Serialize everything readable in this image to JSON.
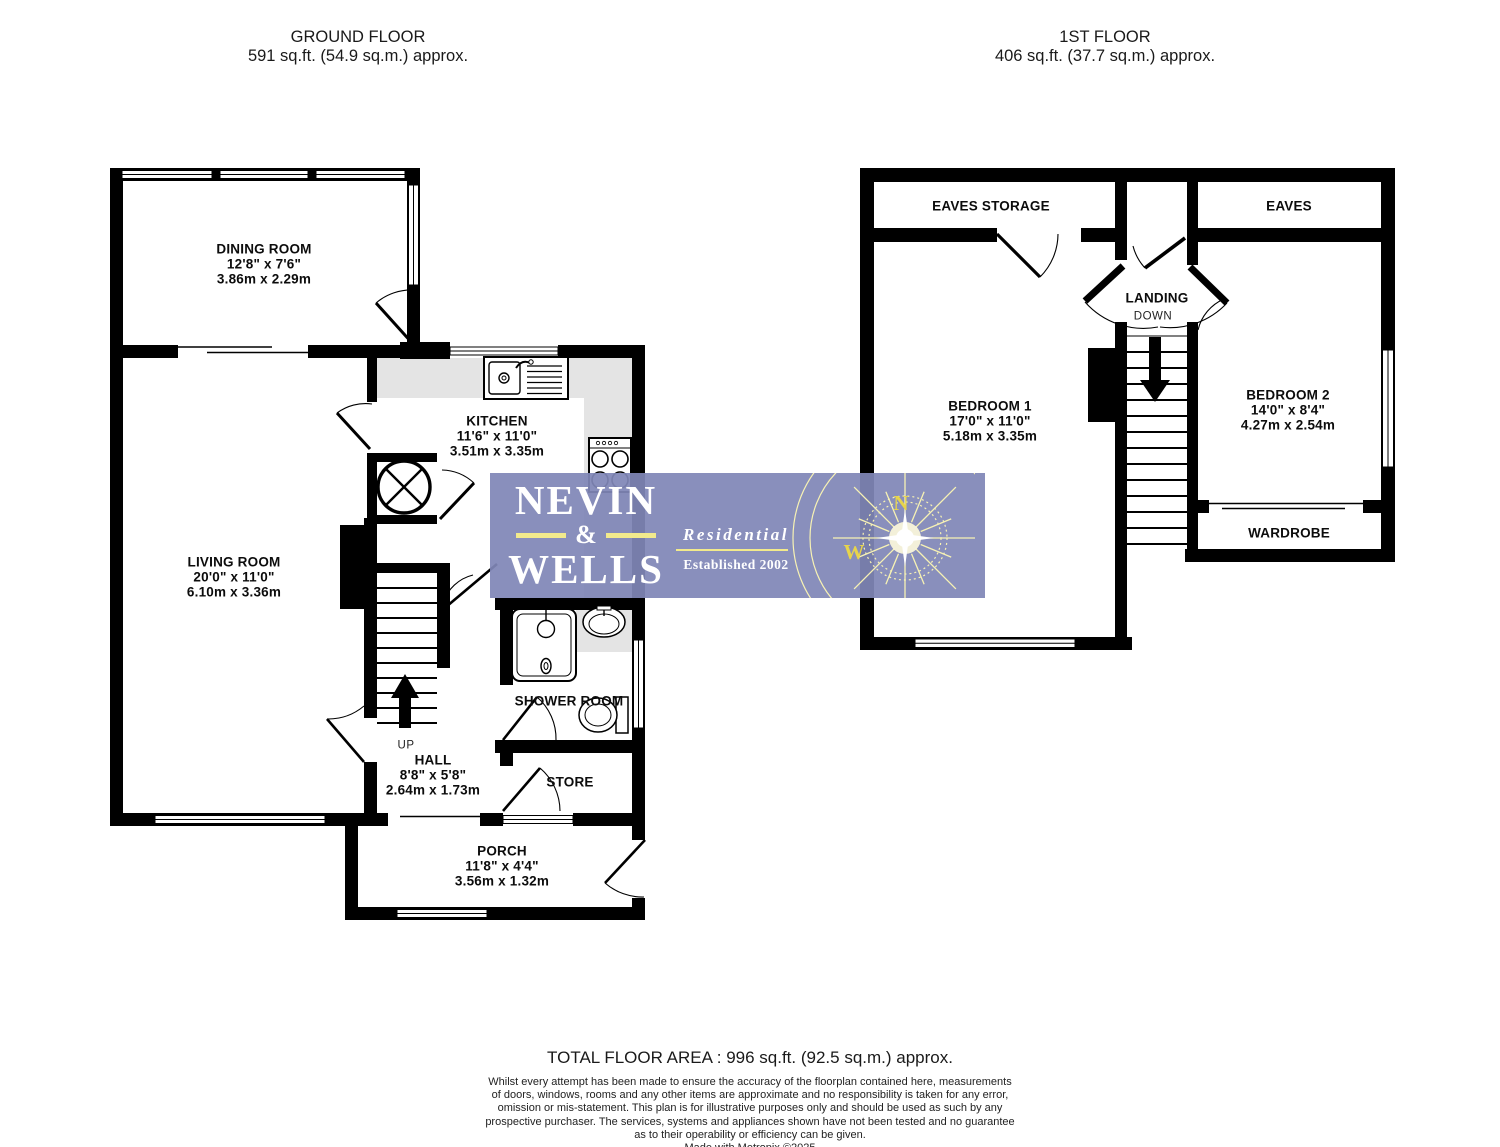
{
  "ground_floor": {
    "title": "GROUND FLOOR",
    "area": "591 sq.ft. (54.9 sq.m.) approx.",
    "rooms": {
      "dining_room": {
        "name": "DINING ROOM",
        "imperial": "12'8\"  x 7'6\"",
        "metric": "3.86m  x 2.29m"
      },
      "living_room": {
        "name": "LIVING ROOM",
        "imperial": "20'0\"  x 11'0\"",
        "metric": "6.10m  x 3.36m"
      },
      "kitchen": {
        "name": "KITCHEN",
        "imperial": "11'6\"  x 11'0\"",
        "metric": "3.51m  x 3.35m"
      },
      "hall": {
        "name": "HALL",
        "imperial": "8'8\"  x 5'8\"",
        "metric": "2.64m  x 1.73m"
      },
      "shower_room": {
        "name": "SHOWER ROOM"
      },
      "store": {
        "name": "STORE"
      },
      "porch": {
        "name": "PORCH",
        "imperial": "11'8\"  x 4'4\"",
        "metric": "3.56m  x 1.32m"
      },
      "up_label": "UP"
    }
  },
  "first_floor": {
    "title": "1ST FLOOR",
    "area": "406 sq.ft. (37.7 sq.m.) approx.",
    "rooms": {
      "eaves_storage": {
        "name": "EAVES STORAGE"
      },
      "eaves": {
        "name": "EAVES"
      },
      "landing": {
        "name": "LANDING",
        "down_label": "DOWN"
      },
      "bedroom_1": {
        "name": "BEDROOM 1",
        "imperial": "17'0\"  x 11'0\"",
        "metric": "5.18m  x 3.35m"
      },
      "bedroom_2": {
        "name": "BEDROOM 2",
        "imperial": "14'0\"  x 8'4\"",
        "metric": "4.27m  x 2.54m"
      },
      "wardrobe": {
        "name": "WARDROBE"
      }
    }
  },
  "logo": {
    "name_top": "NEVIN",
    "ampersand": "&",
    "name_bottom": "WELLS",
    "tagline": "Residential",
    "established": "Established 2002",
    "compass_north": "N",
    "compass_west": "W",
    "bg_color": "#8087b7",
    "accent_yellow": "#f2ea8c"
  },
  "footer": {
    "total": "TOTAL FLOOR AREA : 996 sq.ft. (92.5 sq.m.) approx.",
    "disclaimer": [
      "Whilst every attempt has been made to ensure the accuracy of the floorplan contained here, measurements",
      "of doors, windows, rooms and any other items are approximate and no responsibility is taken for any error,",
      "omission or mis-statement. This plan is for illustrative purposes only and should be used as such by any",
      "prospective purchaser. The services, systems and appliances shown have not been tested and no guarantee",
      "as to their operability or efficiency can be given."
    ],
    "credit": "Made with Metropix ©2025"
  }
}
